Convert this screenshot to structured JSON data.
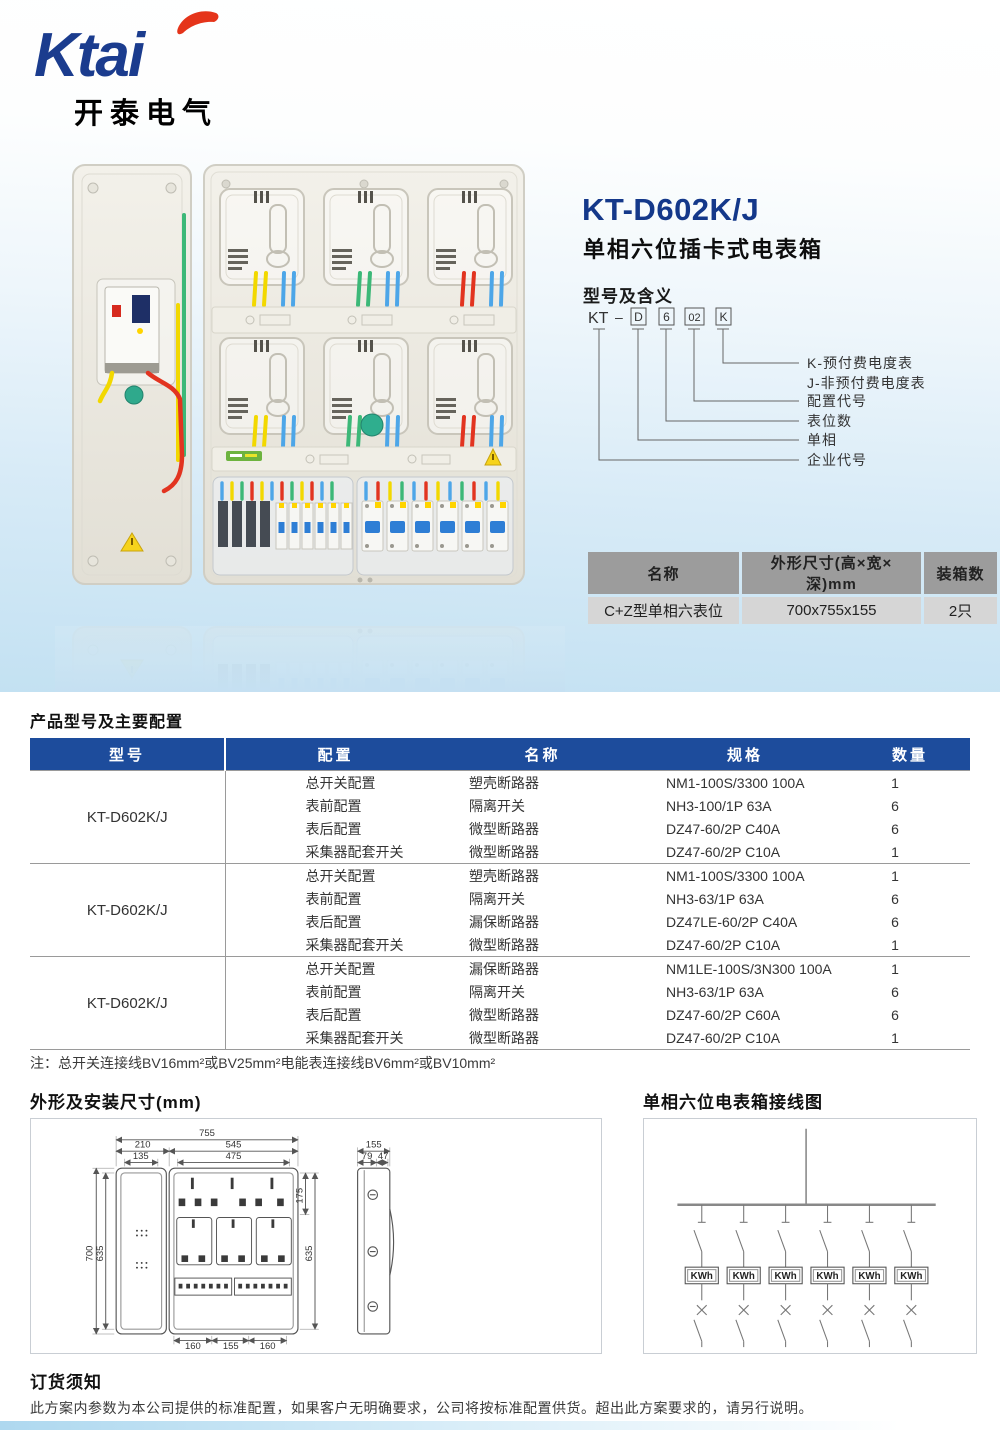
{
  "brand": {
    "logo_text": "Ktai",
    "logo_cn": "开泰电气"
  },
  "product": {
    "model": "KT-D602K/J",
    "name": "单相六位插卡式电表箱",
    "section_model_meaning": "型号及含义",
    "model_code": {
      "prefix": "KT",
      "dash": "–",
      "boxes": [
        "D",
        "6",
        "02",
        "K"
      ]
    },
    "meaning_labels": [
      "K-预付费电度表",
      "J-非预付费电度表",
      "配置代号",
      "表位数",
      "单相",
      "企业代号"
    ]
  },
  "spec_table": {
    "headers": [
      "名称",
      "外形尺寸(高×宽×深)mm",
      "装箱数"
    ],
    "row": [
      "C+Z型单相六表位",
      "700x755x155",
      "2只"
    ]
  },
  "config_section": {
    "title": "产品型号及主要配置",
    "headers": [
      "型号",
      "配置",
      "名称",
      "规格",
      "数量"
    ],
    "groups": [
      {
        "model": "KT-D602K/J",
        "rows": [
          [
            "总开关配置",
            "塑壳断路器",
            "NM1-100S/3300 100A",
            "1"
          ],
          [
            "表前配置",
            "隔离开关",
            "NH3-100/1P 63A",
            "6"
          ],
          [
            "表后配置",
            "微型断路器",
            "DZ47-60/2P C40A",
            "6"
          ],
          [
            "采集器配套开关",
            "微型断路器",
            "DZ47-60/2P C10A",
            "1"
          ]
        ]
      },
      {
        "model": "KT-D602K/J",
        "rows": [
          [
            "总开关配置",
            "塑壳断路器",
            "NM1-100S/3300 100A",
            "1"
          ],
          [
            "表前配置",
            "隔离开关",
            "NH3-63/1P 63A",
            "6"
          ],
          [
            "表后配置",
            "漏保断路器",
            "DZ47LE-60/2P C40A",
            "6"
          ],
          [
            "采集器配套开关",
            "微型断路器",
            "DZ47-60/2P C10A",
            "1"
          ]
        ]
      },
      {
        "model": "KT-D602K/J",
        "rows": [
          [
            "总开关配置",
            "漏保断路器",
            "NM1LE-100S/3N300 100A",
            "1"
          ],
          [
            "表前配置",
            "隔离开关",
            "NH3-63/1P 63A",
            "6"
          ],
          [
            "表后配置",
            "微型断路器",
            "DZ47-60/2P C60A",
            "6"
          ],
          [
            "采集器配套开关",
            "微型断路器",
            "DZ47-60/2P C10A",
            "1"
          ]
        ]
      }
    ],
    "note": "注：总开关连接线BV16mm²或BV25mm²电能表连接线BV6mm²或BV10mm²"
  },
  "dimensions_section": {
    "title": "外形及安装尺寸(mm)",
    "labels": {
      "w_total": "755",
      "w_door": "210",
      "w_main": "545",
      "w_door_inner": "135",
      "w_main_inner": "475",
      "h_top": "175",
      "h_total": "700",
      "h_inner": "635",
      "h_main": "635",
      "b1": "160",
      "b2": "155",
      "b3": "160",
      "side_d": "155",
      "side_d1": "79",
      "side_d2": "47"
    }
  },
  "wiring_section": {
    "title": "单相六位电表箱接线图",
    "meter_label": "KWh"
  },
  "order_section": {
    "title": "订货须知",
    "text": "此方案内参数为本公司提供的标准配置，如果客户无明确要求，公司将按标准配置供货。超出此方案要求的，请另行说明。"
  }
}
